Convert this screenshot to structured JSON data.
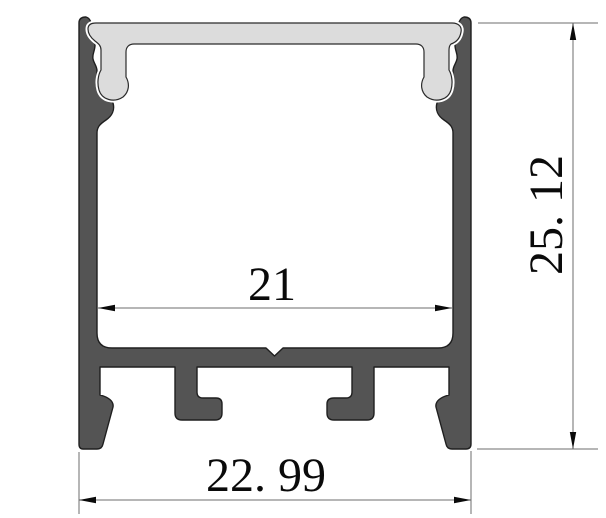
{
  "drawing": {
    "dimensions": {
      "inner_width": "21",
      "outer_width": "22. 99",
      "overall_height": "25. 12"
    },
    "colors": {
      "aluminum_body": "#545454",
      "diffuser_cover": "#dcdcdc",
      "outline": "#1f1f1f",
      "dimension_line": "#6e6e6e",
      "arrow_and_text": "#0a0a0a",
      "background": "#ffffff"
    }
  }
}
